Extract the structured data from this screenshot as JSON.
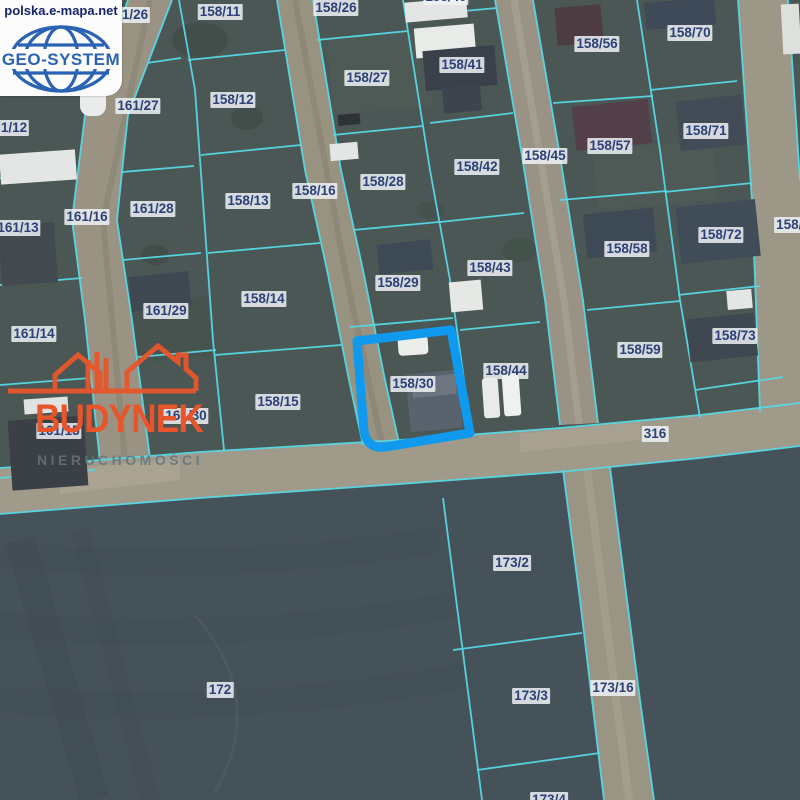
{
  "map": {
    "provider": {
      "url_text": "polska.e-mapa.net",
      "logo_text": "GEO-SYSTEM"
    },
    "agency_watermark": {
      "title": "BUDYNEK",
      "subtitle": "NIERUCHOMOŚCI"
    },
    "highlighted_parcel": "158/30",
    "road_number": "316",
    "colors": {
      "boundary_cyan": "#56d8e6",
      "highlight_blue": "#0f9af0",
      "label_text": "#2c4077",
      "watermark_orange": "#e8552a",
      "logo_blue": "#2b63b4"
    },
    "parcel_labels": [
      {
        "text": "1/26",
        "x": 135,
        "y": 15
      },
      {
        "text": "158/11",
        "x": 220,
        "y": 12
      },
      {
        "text": "158/26",
        "x": 336,
        "y": 8
      },
      {
        "text": "158/40",
        "x": 446,
        "y": -3
      },
      {
        "text": "158/56",
        "x": 597,
        "y": 44
      },
      {
        "text": "158/70",
        "x": 690,
        "y": 33
      },
      {
        "text": "158/41",
        "x": 462,
        "y": 65
      },
      {
        "text": "158/27",
        "x": 367,
        "y": 78
      },
      {
        "text": "158/12",
        "x": 233,
        "y": 100
      },
      {
        "text": "161/27",
        "x": 138,
        "y": 106
      },
      {
        "text": "1/12",
        "x": 14,
        "y": 128
      },
      {
        "text": "158/71",
        "x": 706,
        "y": 131
      },
      {
        "text": "158/57",
        "x": 610,
        "y": 146
      },
      {
        "text": "158/45",
        "x": 545,
        "y": 156
      },
      {
        "text": "158/42",
        "x": 477,
        "y": 167
      },
      {
        "text": "158/28",
        "x": 383,
        "y": 182
      },
      {
        "text": "158/16",
        "x": 315,
        "y": 191
      },
      {
        "text": "158/13",
        "x": 248,
        "y": 201
      },
      {
        "text": "161/28",
        "x": 153,
        "y": 209
      },
      {
        "text": "161/16",
        "x": 87,
        "y": 217
      },
      {
        "text": "158/7",
        "x": 793,
        "y": 225
      },
      {
        "text": "161/13",
        "x": 18,
        "y": 228
      },
      {
        "text": "158/72",
        "x": 721,
        "y": 235
      },
      {
        "text": "158/58",
        "x": 627,
        "y": 249
      },
      {
        "text": "158/43",
        "x": 490,
        "y": 268
      },
      {
        "text": "158/29",
        "x": 398,
        "y": 283
      },
      {
        "text": "158/14",
        "x": 264,
        "y": 299
      },
      {
        "text": "161/29",
        "x": 166,
        "y": 311
      },
      {
        "text": "161/14",
        "x": 34,
        "y": 334
      },
      {
        "text": "158/73",
        "x": 735,
        "y": 336
      },
      {
        "text": "158/59",
        "x": 640,
        "y": 350
      },
      {
        "text": "158/44",
        "x": 506,
        "y": 371
      },
      {
        "text": "158/30",
        "x": 413,
        "y": 384
      },
      {
        "text": "158/15",
        "x": 278,
        "y": 402
      },
      {
        "text": "161/30",
        "x": 186,
        "y": 416
      },
      {
        "text": "161/15",
        "x": 59,
        "y": 431
      },
      {
        "text": "316",
        "x": 655,
        "y": 434
      },
      {
        "text": "173/2",
        "x": 512,
        "y": 563
      },
      {
        "text": "173/16",
        "x": 613,
        "y": 688
      },
      {
        "text": "172",
        "x": 220,
        "y": 690
      },
      {
        "text": "173/3",
        "x": 531,
        "y": 696
      },
      {
        "text": "173/4",
        "x": 549,
        "y": 800
      }
    ]
  }
}
